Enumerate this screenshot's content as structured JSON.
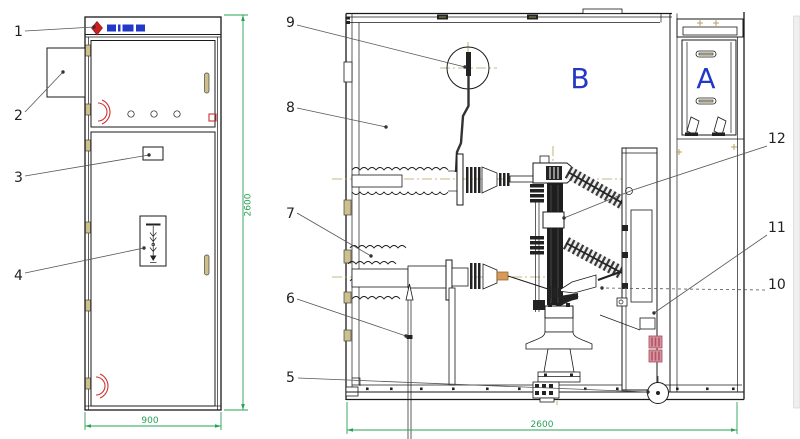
{
  "drawing": {
    "kind": "switchgear-cabinet-engineering-drawing",
    "views": [
      "front",
      "side-section"
    ]
  },
  "callouts": {
    "c1": "1",
    "c2": "2",
    "c3": "3",
    "c4": "4",
    "c5": "5",
    "c6": "6",
    "c7": "7",
    "c8": "8",
    "c9": "9",
    "c10": "10",
    "c11": "11",
    "c12": "12"
  },
  "compartments": {
    "breaker": "B",
    "low_voltage": "A"
  },
  "dimensions": {
    "front_height": "2600",
    "front_width": "900",
    "side_width": "2600"
  },
  "colors": {
    "line": "#1a1a1a",
    "dimension_green": "#2aa055",
    "centerline_olive": "#b0a45e",
    "compartment_label_blue": "#2438c8",
    "logo_red": "#cc1f1f",
    "warning_pink": "#d993a0"
  }
}
